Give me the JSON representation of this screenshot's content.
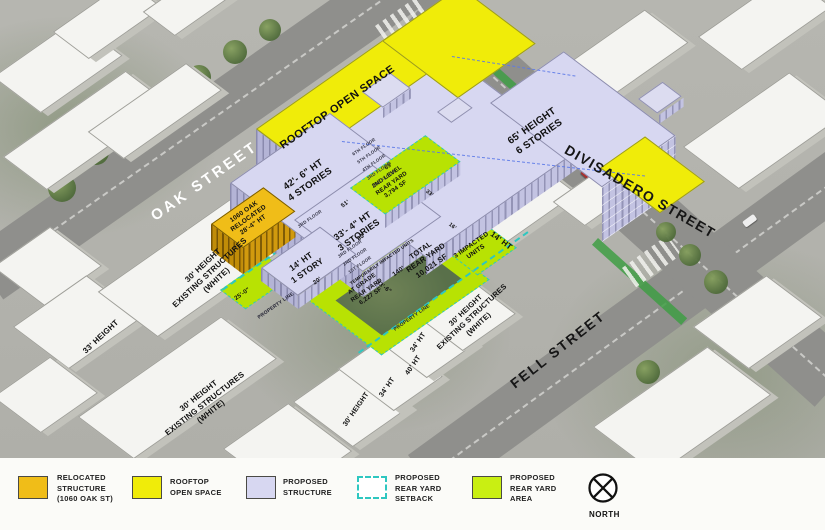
{
  "streets": {
    "oak": "OAK STREET",
    "divisadero": "DIVISADERO STREET",
    "fell": "FELL STREET"
  },
  "site": {
    "rooftop_open_space": "ROOFTOP OPEN SPACE",
    "main_building": "65' HEIGHT\n6 STORIES",
    "west_wing": "42'- 6\" HT\n4 STORIES",
    "mid_building": "33'- 4\" HT\n3 STORIES",
    "one_story": "14' HT\n1 STORY",
    "relocated": "1060 OAK\nRELOCATED\n28'-4\" HT",
    "second_level_yard": "2ND LEVEL\nREAR YARD\n3,794 SF",
    "total_yard": "TOTAL\nREAR YARD\n10,021 SF",
    "grade_yard": "AT GRADE\nREAR YARD\n6,227 SF",
    "impacted_units": "3 IMPACTED\nUNITS",
    "temporarily_impacted": "TEMPORARILY IMPACTED UNITS",
    "property_line": "PROPERTY LINE",
    "right_height": "14' HT"
  },
  "floors_upper": [
    "6TH FLOOR",
    "5TH FLOOR",
    "4TH FLOOR",
    "3RD FLOOR",
    "2ND FLOOR"
  ],
  "floor_mid": "3RD FLOOR",
  "floors_lower": [
    "3RD FLOOR",
    "2ND FLOOR",
    "1ST FLOOR"
  ],
  "dimensions": {
    "d51": "51'",
    "d83": "83'",
    "d63": "63'",
    "d33": "33'",
    "d16": "16'",
    "d20": "20'",
    "d25": "25'-0\"",
    "d140": "140'",
    "d336": "33'-6\""
  },
  "existing": {
    "h33": "33' HEIGHT",
    "block30": "30' HEIGHT\nEXISTING STRUCTURES\n(WHITE)",
    "h30": "30' HEIGHT",
    "h34": "34' HT",
    "h40": "40' HT"
  },
  "colors": {
    "relocated": "#f0bd18",
    "rooftop": "#f0ec09",
    "proposed": "#d7d7f1",
    "setback": "#2ec7c0",
    "rear_yard": "#b8e203"
  },
  "legend": {
    "items": [
      {
        "label": "RELOCATED\nSTRUCTURE\n(1060 OAK ST)",
        "color": "#f0bd18",
        "style": "solid"
      },
      {
        "label": "ROOFTOP\nOPEN SPACE",
        "color": "#f0ec09",
        "style": "solid"
      },
      {
        "label": "PROPOSED\nSTRUCTURE",
        "color": "#d7d7f1",
        "style": "solid"
      },
      {
        "label": "PROPOSED\nREAR YARD\nSETBACK",
        "color": "#2ec7c0",
        "style": "dashed"
      },
      {
        "label": "PROPOSED\nREAR YARD\nAREA",
        "color": "#c9ef12",
        "style": "solid"
      }
    ],
    "north": "NORTH"
  }
}
